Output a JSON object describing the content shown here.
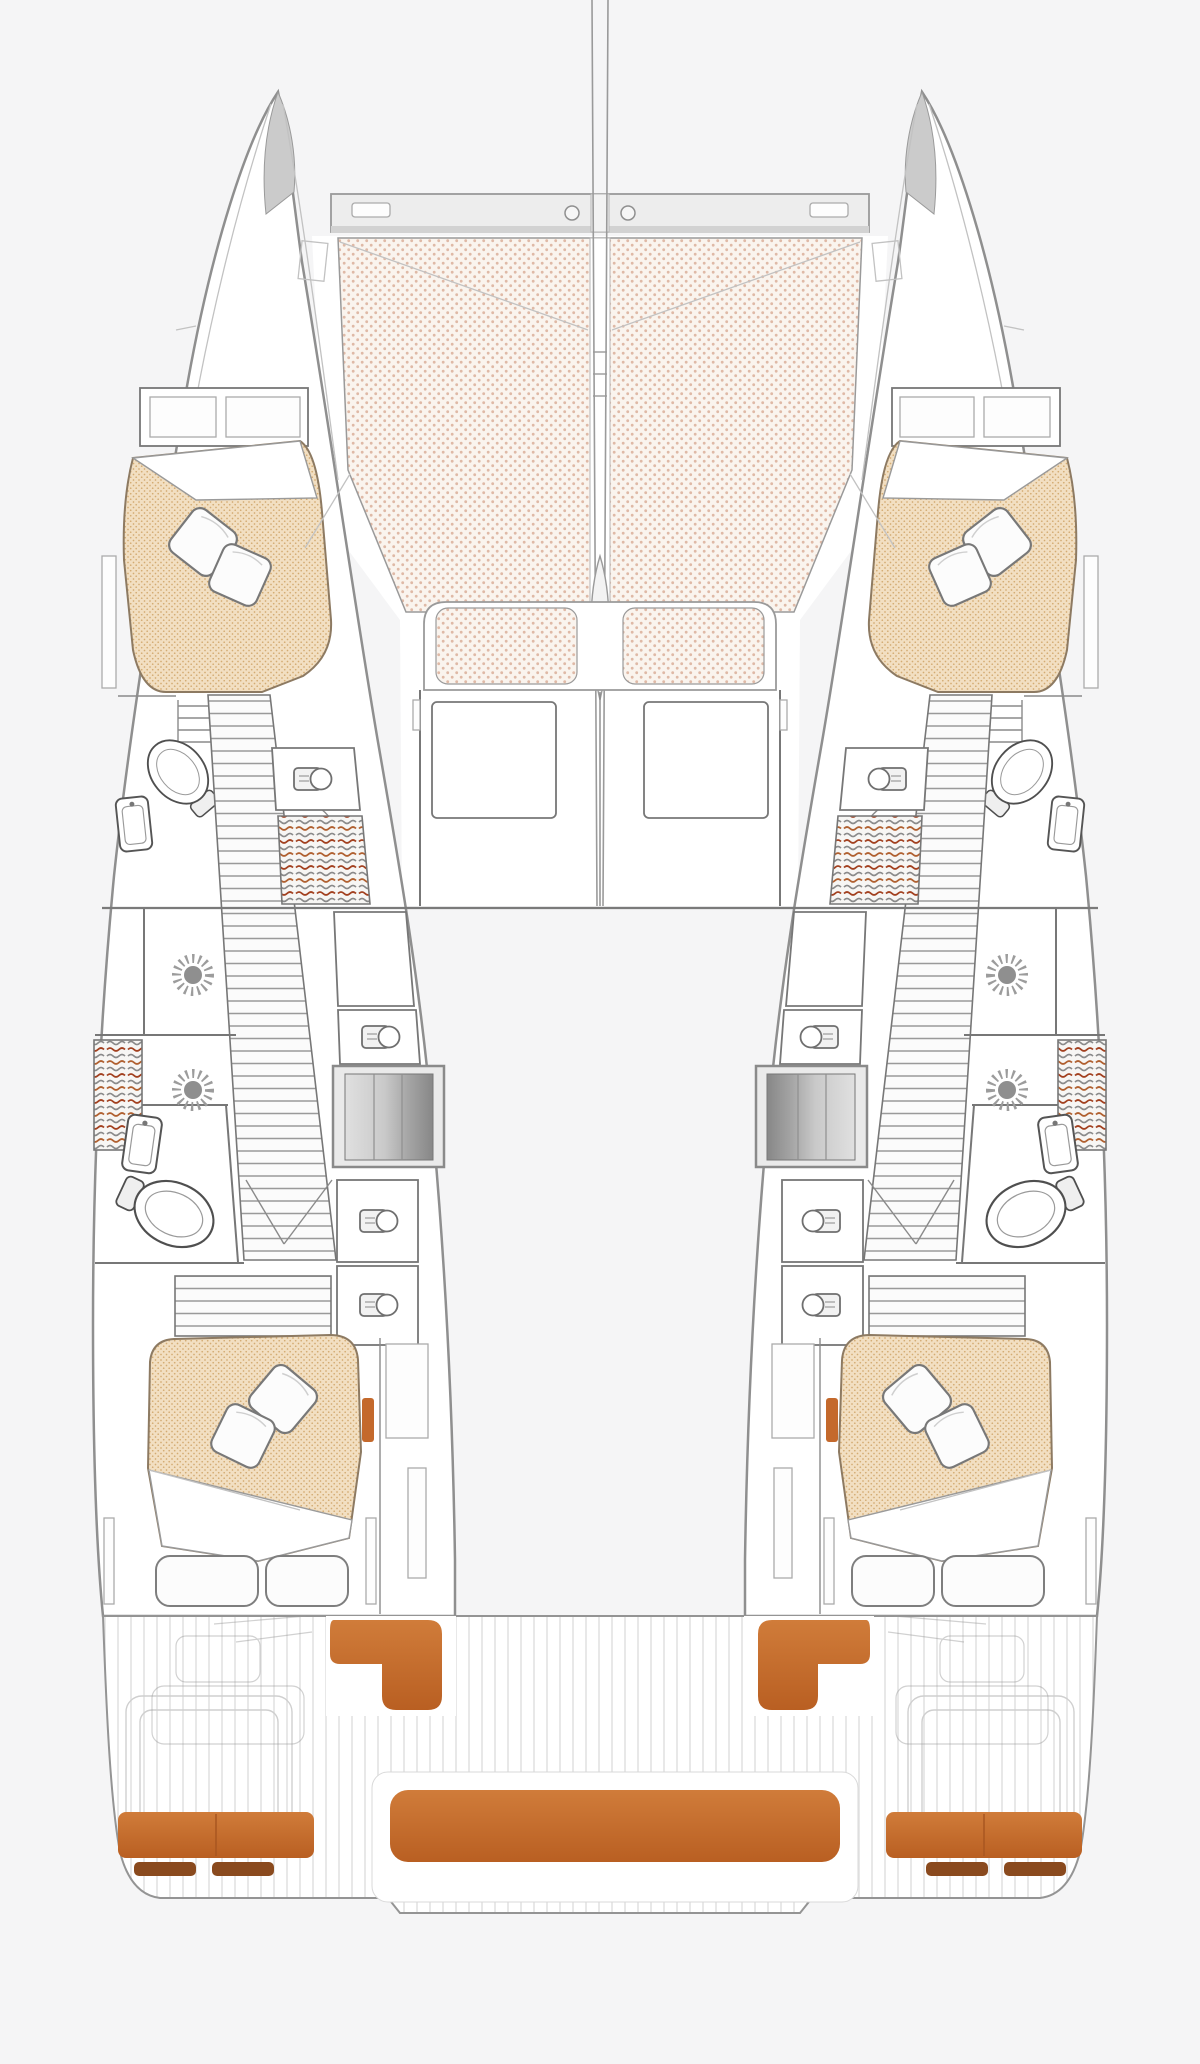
{
  "diagram": {
    "type": "boat-floor-plan",
    "subject": "sailing catamaran interior deck plan, top view, no text labels"
  },
  "palette": {
    "page_bg": "#f5f5f6",
    "hull_outline": "#8f8f8f",
    "hull_fill": "#ffffff",
    "wall": "#777777",
    "trampoline_bg": "#faf4ee",
    "trampoline_dot": "#dfb9a6",
    "mattress_bg": "#f2dfc2",
    "mattress_dot": "#d3ab72",
    "cushion_orange": "#c4692c",
    "cushion_orange_dark": "#8a4a1e",
    "deck_plank": "#e2e2e2",
    "wardrobe_red": "#a2401f",
    "wardrobe_brown": "#b06030"
  },
  "areas": {
    "plan": "catamaran deck plan",
    "mast": "mast and forestay centerline",
    "crossbeam": "forward crossbeam",
    "trampoline": "bow trampoline",
    "forward_cockpit": "forward cockpit seating",
    "port_side": "port hull with cabins and bathrooms",
    "starboard_side": "starboard hull with cabins and bathrooms",
    "aft_cockpit": "aft cockpit and swim platforms",
    "aft_bench": "aft cockpit bench",
    "port_cockpit_seats": "port cockpit seats",
    "starboard_cockpit_seats": "starboard cockpit seats"
  }
}
